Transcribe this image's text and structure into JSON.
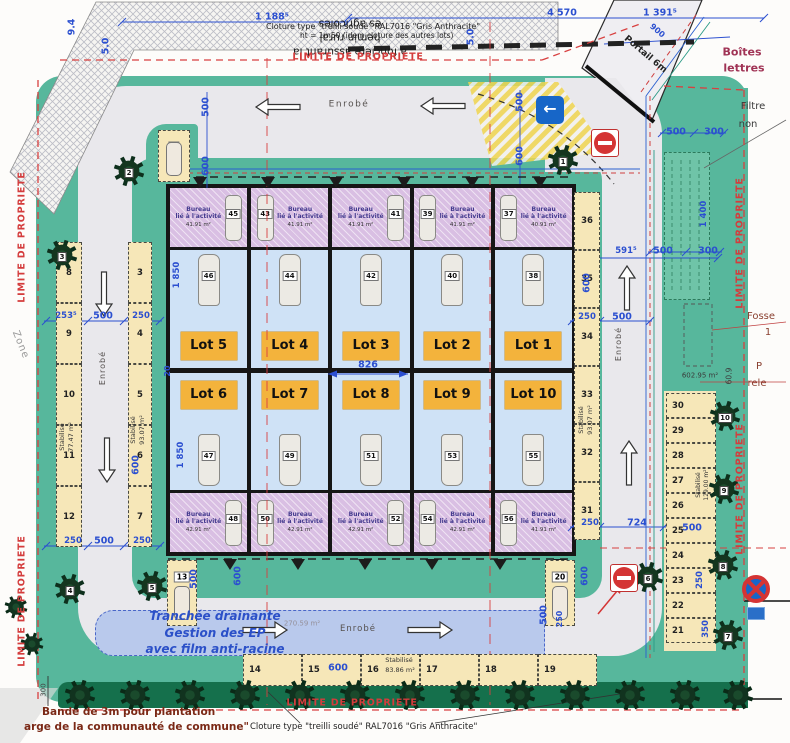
{
  "limite": {
    "text": "LIMITE DE PROPRIETE",
    "positions": [
      {
        "x": 358,
        "y": 57
      },
      {
        "x": 352,
        "y": 703
      },
      {
        "x": 22,
        "y": 237,
        "rot": -90
      },
      {
        "x": 22,
        "y": 601,
        "rot": -90
      },
      {
        "x": 740,
        "y": 243,
        "rot": -90
      },
      {
        "x": 740,
        "y": 489,
        "rot": -90
      }
    ]
  },
  "notes": {
    "fence_top": [
      "Cloture type \"treilli soudé\" RAL7016 \"Gris Anthracite\"",
      "ht = 1m50 (idem cloture des autres lots)"
    ],
    "fence_bottom": "Cloture type \"treilli soudé\" RAL7016 \"Gris Anthracite\"",
    "rural": [
      "a foncière assurant la",
      "hemin rural",
      "es agricoles"
    ],
    "plantation": [
      "Bande de 3m pour plantation",
      "arge de la communauté de commune\""
    ],
    "trench": [
      "Tranchée drainante",
      "Gestion des EP",
      "avec film anti-racine"
    ]
  },
  "building": {
    "office_lines": [
      "Bureau",
      "lié à l'activité"
    ],
    "top": [
      {
        "lot": "Lot 5",
        "office": "45",
        "van": "46",
        "area": "41.91 m²",
        "side": "right"
      },
      {
        "lot": "Lot 4",
        "office": "43",
        "van": "44",
        "area": "41.91 m²",
        "side": "left"
      },
      {
        "lot": "Lot 3",
        "office": "41",
        "van": "42",
        "area": "41.91 m²",
        "side": "right"
      },
      {
        "lot": "Lot 2",
        "office": "39",
        "van": "40",
        "area": "41.91 m²",
        "side": "left"
      },
      {
        "lot": "Lot 1",
        "office": "37",
        "van": "38",
        "area": "40.91 m²",
        "side": "left"
      }
    ],
    "bottom": [
      {
        "lot": "Lot 6",
        "office": "48",
        "van": "47",
        "area": "42.91 m²",
        "side": "right"
      },
      {
        "lot": "Lot 7",
        "office": "50",
        "van": "49",
        "area": "42.91 m²",
        "side": "left"
      },
      {
        "lot": "Lot 8",
        "office": "52",
        "van": "51",
        "area": "42.91 m²",
        "side": "right"
      },
      {
        "lot": "Lot 9",
        "office": "54",
        "van": "53",
        "area": "42.91 m²",
        "side": "left"
      },
      {
        "lot": "Lot 10",
        "office": "56",
        "van": "55",
        "area": "41.91 m²",
        "side": "left"
      }
    ]
  },
  "parking": {
    "columns": [
      {
        "x": 56,
        "w": 26,
        "y0": 242,
        "h": 61,
        "nums": [
          "8",
          "9",
          "10",
          "11",
          "12"
        ]
      },
      {
        "x": 128,
        "w": 24,
        "y0": 242,
        "h": 61,
        "nums": [
          "3",
          "4",
          "5",
          "6",
          "7"
        ]
      },
      {
        "x": 574,
        "w": 26,
        "y0": 192,
        "h": 58,
        "nums": [
          "36",
          "35",
          "34",
          "33",
          "32",
          "31"
        ]
      },
      {
        "x": 666,
        "w": 50,
        "y0": 393,
        "h": 25,
        "nums": [
          "30",
          "29",
          "28",
          "27",
          "26",
          "25",
          "24",
          "23",
          "22",
          "21"
        ],
        "horiz": true
      }
    ],
    "row": {
      "y": 654,
      "h": 32,
      "x0": 243,
      "w": 59,
      "nums": [
        "14",
        "15",
        "16",
        "17",
        "18",
        "19"
      ]
    },
    "single": [
      {
        "n": "1",
        "x": 158,
        "y": 130,
        "w": 32,
        "h": 52
      },
      {
        "n": "13",
        "x": 167,
        "y": 560,
        "w": 30,
        "h": 66
      },
      {
        "n": "20",
        "x": 545,
        "y": 560,
        "w": 30,
        "h": 66
      }
    ]
  },
  "trees": {
    "numbered": [
      {
        "x": 563,
        "y": 160,
        "n": "1"
      },
      {
        "x": 129,
        "y": 171,
        "n": "2"
      },
      {
        "x": 62,
        "y": 255,
        "n": "3"
      },
      {
        "x": 70,
        "y": 589,
        "n": "4"
      },
      {
        "x": 152,
        "y": 586,
        "n": "5"
      },
      {
        "x": 648,
        "y": 577,
        "n": "6"
      },
      {
        "x": 728,
        "y": 635,
        "n": "7"
      },
      {
        "x": 723,
        "y": 565,
        "n": "8"
      },
      {
        "x": 724,
        "y": 489,
        "n": "9"
      },
      {
        "x": 725,
        "y": 416,
        "n": "10"
      }
    ],
    "band_y": 695,
    "band_x": [
      80,
      135,
      190,
      245,
      300,
      355,
      410,
      465,
      520,
      575,
      630,
      685,
      738
    ],
    "extra": [
      {
        "x": 16,
        "y": 607
      },
      {
        "x": 32,
        "y": 644
      }
    ]
  },
  "road_arrows": [
    {
      "x": 300,
      "y": 107,
      "a": 180
    },
    {
      "x": 465,
      "y": 106,
      "a": 180
    },
    {
      "x": 104,
      "y": 272,
      "a": 90
    },
    {
      "x": 107,
      "y": 438,
      "a": 90
    },
    {
      "x": 627,
      "y": 310,
      "a": 270
    },
    {
      "x": 629,
      "y": 485,
      "a": 270
    },
    {
      "x": 243,
      "y": 630,
      "a": 0
    },
    {
      "x": 408,
      "y": 630,
      "a": 0
    }
  ],
  "labels": [
    {
      "t": "1 188⁵",
      "x": 272,
      "y": 17
    },
    {
      "t": "4 570",
      "x": 562,
      "y": 13
    },
    {
      "t": "1 391⁵",
      "x": 660,
      "y": 13
    },
    {
      "t": "9.4",
      "x": 72,
      "y": 27,
      "rot": -90
    },
    {
      "t": "5.0",
      "x": 106,
      "y": 46,
      "rot": -90
    },
    {
      "t": "5.0",
      "x": 471,
      "y": 37,
      "rot": -90
    },
    {
      "t": "500",
      "x": 206,
      "y": 107,
      "rot": -90
    },
    {
      "t": "600",
      "x": 206,
      "y": 166,
      "rot": -90
    },
    {
      "t": "500",
      "x": 520,
      "y": 102,
      "rot": -90
    },
    {
      "t": "600",
      "x": 520,
      "y": 156,
      "rot": -90
    },
    {
      "t": "1 850",
      "x": 177,
      "y": 275,
      "rot": -90,
      "s": 8.5
    },
    {
      "t": "1 850",
      "x": 181,
      "y": 455,
      "rot": -90,
      "s": 8.5
    },
    {
      "t": "20",
      "x": 168,
      "y": 371,
      "rot": -90,
      "s": 8
    },
    {
      "t": "826",
      "x": 368,
      "y": 365
    },
    {
      "t": "253⁵",
      "x": 66,
      "y": 316,
      "s": 8.5
    },
    {
      "t": "500",
      "x": 103,
      "y": 316
    },
    {
      "t": "250",
      "x": 141,
      "y": 316,
      "s": 8.5
    },
    {
      "t": "250",
      "x": 73,
      "y": 541,
      "s": 8.5
    },
    {
      "t": "500",
      "x": 104,
      "y": 541
    },
    {
      "t": "250",
      "x": 142,
      "y": 541,
      "s": 8.5
    },
    {
      "t": "600",
      "x": 136,
      "y": 465,
      "rot": -90
    },
    {
      "t": "Stabilisé",
      "x": 62,
      "y": 437,
      "rot": -90,
      "s": 6.5,
      "c": "#333",
      "b": false
    },
    {
      "t": "77.47 m²",
      "x": 71,
      "y": 437,
      "rot": -90,
      "s": 6.5,
      "c": "#333",
      "b": false
    },
    {
      "t": "Stabilisé",
      "x": 133,
      "y": 430,
      "rot": -90,
      "s": 6.5,
      "c": "#333",
      "b": false
    },
    {
      "t": "93.07 m²",
      "x": 142,
      "y": 430,
      "rot": -90,
      "s": 6.5,
      "c": "#333",
      "b": false
    },
    {
      "t": "591⁵",
      "x": 626,
      "y": 251,
      "s": 8.5
    },
    {
      "t": "600",
      "x": 587,
      "y": 283,
      "rot": -90
    },
    {
      "t": "250",
      "x": 587,
      "y": 317,
      "s": 8.5
    },
    {
      "t": "500",
      "x": 622,
      "y": 317
    },
    {
      "t": "Stabilisé",
      "x": 581,
      "y": 420,
      "rot": -90,
      "s": 6.5,
      "c": "#333",
      "b": false
    },
    {
      "t": "93.07 m²",
      "x": 590,
      "y": 420,
      "rot": -90,
      "s": 6.5,
      "c": "#333",
      "b": false
    },
    {
      "t": "250",
      "x": 590,
      "y": 523,
      "s": 8.5
    },
    {
      "t": "724",
      "x": 637,
      "y": 523
    },
    {
      "t": "500",
      "x": 692,
      "y": 528
    },
    {
      "t": "Stabilisé",
      "x": 699,
      "y": 485,
      "rot": -90,
      "s": 6,
      "c": "#333",
      "b": false
    },
    {
      "t": "129.00 m²",
      "x": 707,
      "y": 485,
      "rot": -90,
      "s": 6,
      "c": "#333",
      "b": false
    },
    {
      "t": "250",
      "x": 700,
      "y": 580,
      "rot": -90,
      "s": 8.5
    },
    {
      "t": "350",
      "x": 706,
      "y": 629,
      "rot": -90,
      "s": 8.5
    },
    {
      "t": "500",
      "x": 676,
      "y": 132
    },
    {
      "t": "300",
      "x": 714,
      "y": 132
    },
    {
      "t": "500",
      "x": 663,
      "y": 251
    },
    {
      "t": "300",
      "x": 708,
      "y": 251
    },
    {
      "t": "1 400",
      "x": 704,
      "y": 214,
      "rot": -90,
      "s": 8.5
    },
    {
      "t": "500",
      "x": 194,
      "y": 579,
      "rot": -90
    },
    {
      "t": "600",
      "x": 238,
      "y": 576,
      "rot": -90
    },
    {
      "t": "600",
      "x": 585,
      "y": 576,
      "rot": -90
    },
    {
      "t": "500",
      "x": 544,
      "y": 615,
      "rot": -90
    },
    {
      "t": "250",
      "x": 560,
      "y": 619,
      "rot": -90,
      "s": 8
    },
    {
      "t": "600",
      "x": 338,
      "y": 668
    },
    {
      "t": "270.59 m²",
      "x": 302,
      "y": 624,
      "s": 7,
      "c": "#95909a",
      "b": false
    },
    {
      "t": "300",
      "x": 44,
      "y": 690,
      "rot": -90,
      "s": 7,
      "c": "#444",
      "b": false
    },
    {
      "t": "900",
      "x": 657,
      "y": 31,
      "rot": 40,
      "s": 8
    },
    {
      "t": "602.95 m²",
      "x": 700,
      "y": 376,
      "s": 7,
      "c": "#3a3a3a",
      "b": false
    },
    {
      "t": "60.9",
      "x": 729,
      "y": 376,
      "rot": -90,
      "s": 7.5,
      "c": "#3a3a3a",
      "b": false
    },
    {
      "t": "Stabilisé",
      "x": 399,
      "y": 660,
      "s": 6.5,
      "c": "#333",
      "b": false
    },
    {
      "t": "83.86 m²",
      "x": 400,
      "y": 670,
      "s": 6.5,
      "c": "#333",
      "b": false
    },
    {
      "t": "Enrobé",
      "x": 349,
      "y": 105,
      "s": 9,
      "c": "#55504e",
      "b": false,
      "ls": 1.5
    },
    {
      "t": "Enrobé",
      "x": 103,
      "y": 368,
      "rot": -90,
      "s": 8,
      "c": "#55504e",
      "b": false,
      "ls": 1
    },
    {
      "t": "Enrobé",
      "x": 619,
      "y": 344,
      "rot": -90,
      "s": 8,
      "c": "#55504e",
      "b": false,
      "ls": 1
    },
    {
      "t": "Enrobé",
      "x": 358,
      "y": 629,
      "s": 8.5,
      "c": "#55504e",
      "b": false,
      "ls": 1
    },
    {
      "t": "Boîtes",
      "x": 742,
      "y": 52,
      "s": 11,
      "c": "#a03355"
    },
    {
      "t": "lettres",
      "x": 744,
      "y": 68,
      "s": 11,
      "c": "#a03355"
    },
    {
      "t": "Filtre",
      "x": 753,
      "y": 107,
      "s": 10,
      "c": "#3a3a3a",
      "b": false
    },
    {
      "t": "non",
      "x": 748,
      "y": 125,
      "s": 10,
      "c": "#3a3a3a",
      "b": false
    },
    {
      "t": "Fosse",
      "x": 761,
      "y": 317,
      "s": 10,
      "c": "#8a4030",
      "b": false
    },
    {
      "t": "1",
      "x": 768,
      "y": 333,
      "s": 10,
      "c": "#8a4030",
      "b": false
    },
    {
      "t": "P",
      "x": 759,
      "y": 367,
      "s": 10,
      "c": "#8a4030",
      "b": false
    },
    {
      "t": "rele",
      "x": 757,
      "y": 384,
      "s": 10,
      "c": "#8a4030",
      "b": false
    },
    {
      "t": "Portail 6m",
      "x": 645,
      "y": 55,
      "rot": 40,
      "s": 9,
      "c": "#222"
    },
    {
      "t": "Zone",
      "x": 20,
      "y": 345,
      "rot": 68,
      "s": 10,
      "c": "#9a9a9a",
      "b": false,
      "ls": 1
    }
  ],
  "colors": {
    "site_green": "#57b79c",
    "plantation_band": "#15704c",
    "road": "#e9e8ec",
    "lot_badge": "#f3b33c",
    "stall_yellow": "#f6e7b8",
    "office_purple": "#d9bfe3",
    "unit_blue": "#cfe2f6",
    "dim_blue": "#2b4fd0",
    "limite_red": "#d43c3c",
    "trench_blue": "#b9c9ec"
  }
}
